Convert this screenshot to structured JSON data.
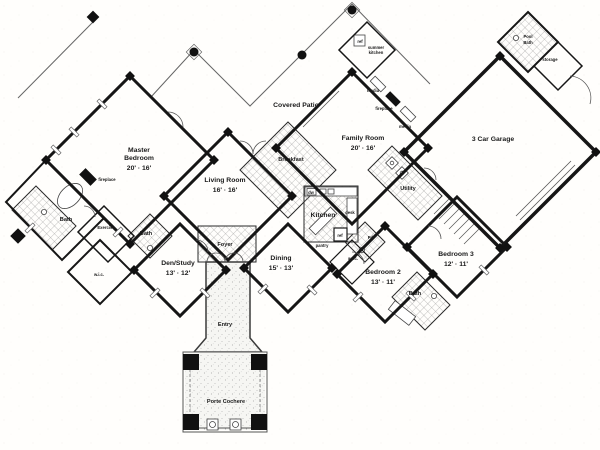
{
  "title": "House Floor Plan",
  "colors": {
    "wall": "#161616",
    "paper": "#fffefc",
    "tile_line": "#8a8a8a",
    "stipple": "#9a9a9a"
  },
  "rooms": {
    "master_bedroom": {
      "line1": "Master",
      "line2": "Bedroom",
      "dims": "20' · 16'"
    },
    "living_room": {
      "label": "Living Room",
      "dims": "16' · 16'"
    },
    "family_room": {
      "label": "Family Room",
      "dims": "20' · 16'"
    },
    "den_study": {
      "label": "Den/Study",
      "dims": "13' · 12'"
    },
    "dining": {
      "label": "Dining",
      "dims": "15' · 13'"
    },
    "bedroom_2": {
      "label": "Bedroom 2",
      "dims": "13' · 11'"
    },
    "bedroom_3": {
      "label": "Bedroom 3",
      "dims": "12' · 11'"
    },
    "garage": {
      "label": "3 Car Garage"
    },
    "covered_patio": {
      "label": "Covered Patio"
    },
    "breakfast": {
      "label": "Breakfast"
    },
    "kitchen": {
      "label": "Kitchen"
    },
    "foyer": {
      "label": "Foyer"
    },
    "entry": {
      "label": "Entry"
    },
    "porte_cochere": {
      "label": "Porte Cochere"
    },
    "utility": {
      "label": "Utility"
    },
    "master_bath": {
      "label": "Bath"
    },
    "den_bath": {
      "label": "Bath"
    },
    "bedroom_bath": {
      "label": "Bath"
    },
    "pool_bath": {
      "line1": "Pool",
      "line2": "Bath"
    },
    "exercise": {
      "label": "Exercise"
    },
    "master_wic": {
      "label": "w.i.c."
    },
    "bedroom2_wic": {
      "label": "w.i.c."
    },
    "powder": {
      "label": "Pd."
    },
    "storage": {
      "label": "storage"
    },
    "summer_kitchen": {
      "line1": "summer",
      "line2": "kitchen"
    }
  },
  "features": {
    "master_fireplace": "fireplace",
    "family_fireplace": "fireplace",
    "media_upper": "media",
    "media_lower": "media",
    "summer_ref": "ref",
    "kitchen_ref": "ref",
    "pantry": "pantry",
    "dishwasher": "dw",
    "desk": "desk"
  }
}
